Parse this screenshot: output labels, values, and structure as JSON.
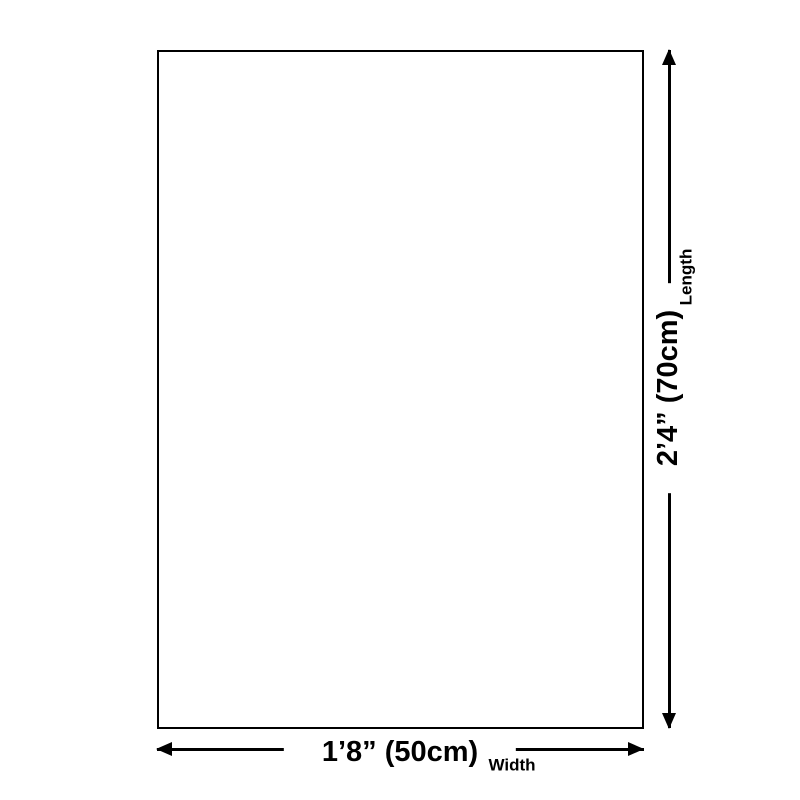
{
  "diagram": {
    "background_color": "#ffffff",
    "line_color": "#000000",
    "width_dimension": {
      "value": "1’8” (50cm)",
      "label": "Width"
    },
    "length_dimension": {
      "value": "2’4” (70cm)",
      "label": "Length"
    }
  }
}
